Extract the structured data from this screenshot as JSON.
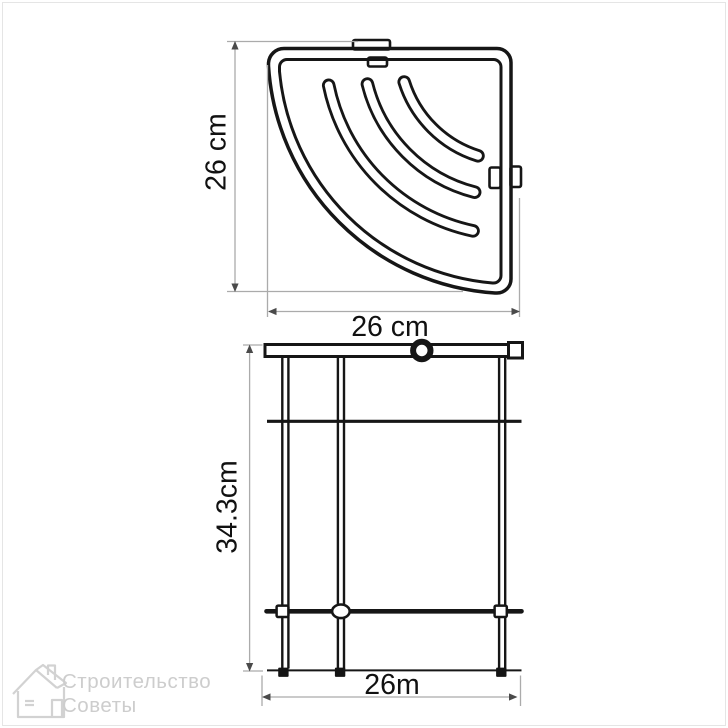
{
  "drawing": {
    "top_view": {
      "height_label": "26 cm",
      "width_label": "26 cm"
    },
    "front_view": {
      "height_label": "34.3cm",
      "width_label": "26m"
    }
  },
  "watermark": {
    "line1": "Строительство",
    "line2": "Советы",
    "icon": "house-icon"
  },
  "colors": {
    "background": "#ffffff",
    "page_border": "#e5e5e5",
    "outline": "#161616",
    "dimension_line": "#ababab",
    "dimension_arrow": "#4a4a4a",
    "label_text": "#111111",
    "watermark": "#cfcfcf"
  }
}
